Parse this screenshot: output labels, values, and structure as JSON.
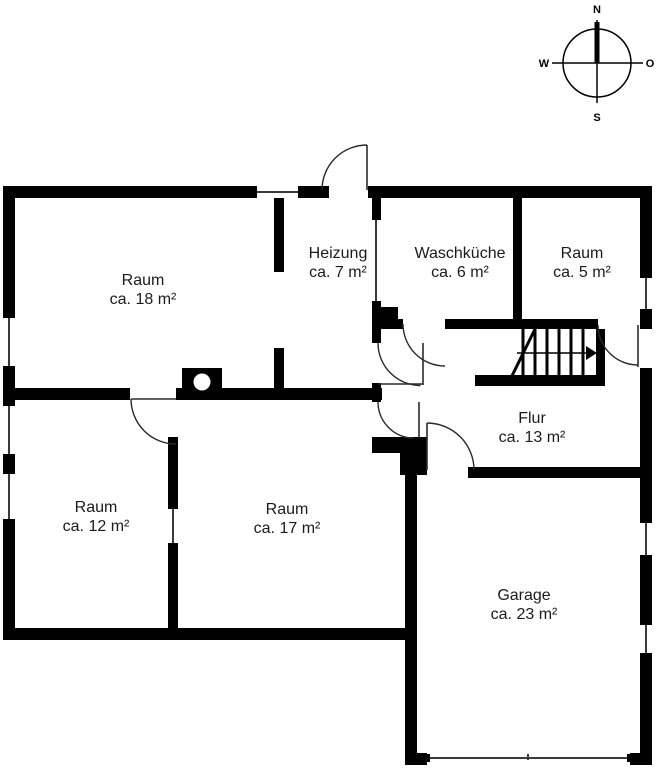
{
  "plan_title": "Grundriss",
  "compass": {
    "north": "N",
    "east": "O",
    "south": "S",
    "west": "W"
  },
  "rooms": [
    {
      "id": "raum-18",
      "name": "Raum",
      "area": "ca. 18 m²"
    },
    {
      "id": "heizung",
      "name": "Heizung",
      "area": "ca. 7 m²"
    },
    {
      "id": "waschkueche",
      "name": "Waschküche",
      "area": "ca. 6 m²"
    },
    {
      "id": "raum-5",
      "name": "Raum",
      "area": "ca. 5 m²"
    },
    {
      "id": "flur",
      "name": "Flur",
      "area": "ca. 13 m²"
    },
    {
      "id": "raum-12",
      "name": "Raum",
      "area": "ca. 12 m²"
    },
    {
      "id": "raum-17",
      "name": "Raum",
      "area": "ca. 17 m²"
    },
    {
      "id": "garage",
      "name": "Garage",
      "area": "ca. 23 m²"
    }
  ],
  "colors": {
    "walls": "#000000",
    "background": "#ffffff",
    "text": "#1b1b1b"
  }
}
